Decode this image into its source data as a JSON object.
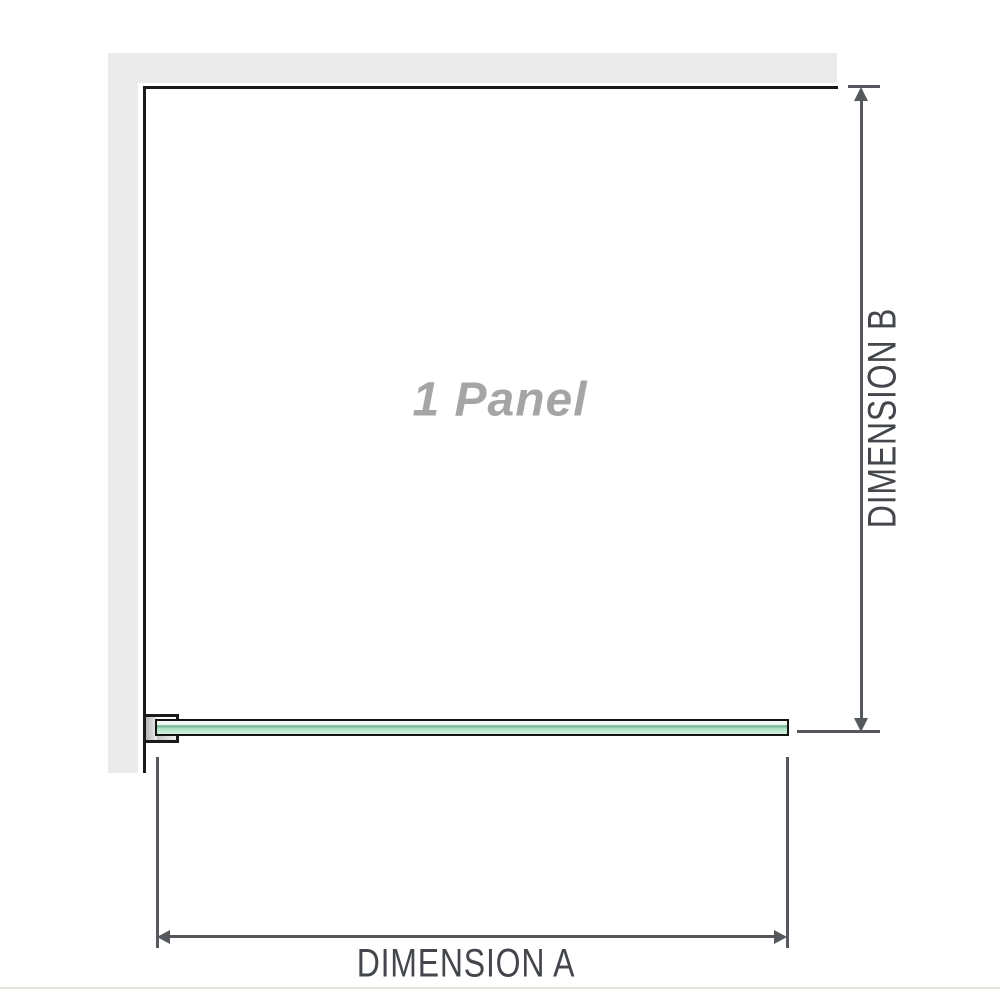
{
  "diagram": {
    "panel_label": "1 Panel",
    "dimension_a": {
      "label": "DIMENSION A"
    },
    "dimension_b": {
      "label": "DIMENSION B"
    }
  },
  "colors": {
    "wall": "#ebebeb",
    "wall_edge": "#1a1a1a",
    "dim_line": "#55585c",
    "dim_text": "#43474b",
    "panel_text": "#a5a5a5",
    "glass_pale": "#ecf7f0",
    "glass_dark": "#74b493",
    "glass_mid": "#a6dcc0",
    "glass_light": "#d8f1e0",
    "bracket_metal": "#b5b5b5",
    "separator": "#e5e2dc"
  }
}
